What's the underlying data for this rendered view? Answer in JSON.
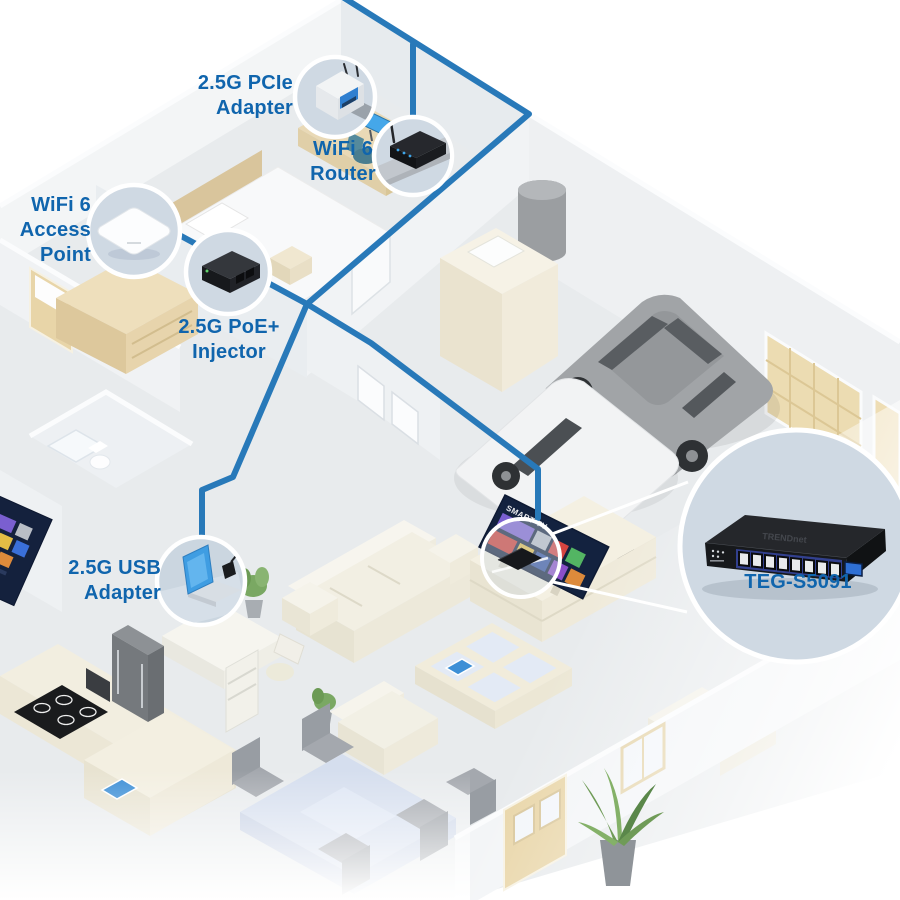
{
  "diagram_type": "home-network-isometric-floorplan",
  "colors": {
    "label_text": "#1065ad",
    "cable": "#2879b9",
    "callout_fill": "#cfd9e3",
    "callout_ring": "#ffffff",
    "floor": "#e8ebed",
    "wall": "#f1f3f5",
    "screen_blue": "#45a7e9"
  },
  "callouts": {
    "pcie_adapter": {
      "label_lines": [
        "2.5G PCIe",
        "Adapter"
      ]
    },
    "wifi_router": {
      "label_lines": [
        "WiFi 6",
        "Router"
      ]
    },
    "access_point": {
      "label_lines": [
        "WiFi 6",
        "Access",
        "Point"
      ]
    },
    "poe_injector": {
      "label_lines": [
        "2.5G PoE+",
        "Injector"
      ]
    },
    "usb_adapter": {
      "label_lines": [
        "2.5G USB",
        "Adapter"
      ]
    },
    "network_switch": {
      "label_lines": [
        "TEG-S5091"
      ]
    }
  },
  "devices": {
    "smart_tv_screen_label": "SMART TV",
    "switch_brand": "TRENDnet",
    "switch_model": "TEG-S5091",
    "switch_rj45_ports": 8,
    "switch_sfp_ports": 1
  }
}
